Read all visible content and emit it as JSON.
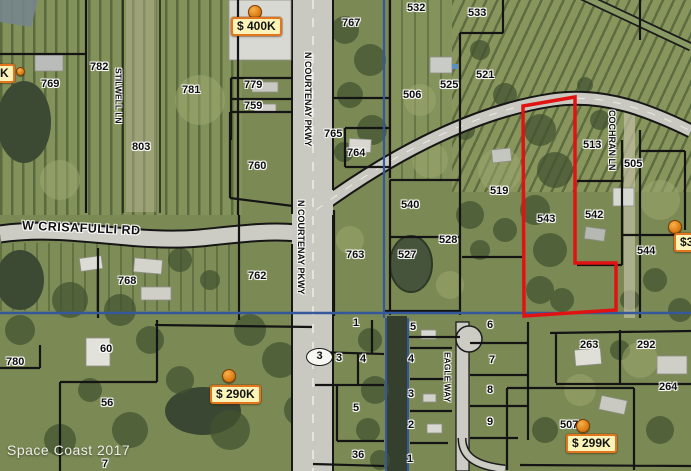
{
  "map": {
    "attribution": "Space Coast 2017",
    "route_shield": "3",
    "colors": {
      "badge_bg": "#fbf3b8",
      "badge_border": "#e2761e",
      "pin_orange": "#e0821a",
      "selected_parcel_outline": "#e01212",
      "utility_line_blue": "#35589c",
      "parcel_line_black": "#141414"
    },
    "road_labels": [
      {
        "text": "N COURTENAY PKWY",
        "x": 303,
        "y": 52,
        "cls": "vert"
      },
      {
        "text": "N COURTENAY PKWY",
        "x": 296,
        "y": 200,
        "cls": "vert"
      },
      {
        "text": "STILWELL LN",
        "x": 114,
        "y": 68,
        "cls": "vert tight"
      },
      {
        "text": "COCHRAN LN",
        "x": 607,
        "y": 110,
        "cls": "vert"
      },
      {
        "text": "EAGLE WAY",
        "x": 443,
        "y": 352,
        "cls": "vert tight"
      },
      {
        "text": "W CRISAFULLI RD",
        "x": 22,
        "y": 222,
        "cls": "horiz"
      }
    ],
    "parcel_labels": [
      {
        "text": "782",
        "x": 90,
        "y": 62
      },
      {
        "text": "769",
        "x": 41,
        "y": 79
      },
      {
        "text": "781",
        "x": 182,
        "y": 85
      },
      {
        "text": "803",
        "x": 132,
        "y": 142
      },
      {
        "text": "779",
        "x": 244,
        "y": 80
      },
      {
        "text": "759",
        "x": 244,
        "y": 101
      },
      {
        "text": "767",
        "x": 342,
        "y": 18
      },
      {
        "text": "532",
        "x": 407,
        "y": 3
      },
      {
        "text": "533",
        "x": 468,
        "y": 8
      },
      {
        "text": "521",
        "x": 476,
        "y": 70
      },
      {
        "text": "525",
        "x": 440,
        "y": 80
      },
      {
        "text": "506",
        "x": 403,
        "y": 90
      },
      {
        "text": "513",
        "x": 583,
        "y": 140
      },
      {
        "text": "505",
        "x": 624,
        "y": 159
      },
      {
        "text": "760",
        "x": 248,
        "y": 161
      },
      {
        "text": "765",
        "x": 324,
        "y": 129
      },
      {
        "text": "764",
        "x": 347,
        "y": 148
      },
      {
        "text": "763",
        "x": 346,
        "y": 250
      },
      {
        "text": "540",
        "x": 401,
        "y": 200
      },
      {
        "text": "528",
        "x": 439,
        "y": 235
      },
      {
        "text": "527",
        "x": 398,
        "y": 250
      },
      {
        "text": "519",
        "x": 490,
        "y": 186
      },
      {
        "text": "543",
        "x": 537,
        "y": 214
      },
      {
        "text": "542",
        "x": 585,
        "y": 210
      },
      {
        "text": "544",
        "x": 637,
        "y": 246
      },
      {
        "text": "762",
        "x": 248,
        "y": 271
      },
      {
        "text": "768",
        "x": 118,
        "y": 276
      },
      {
        "text": "780",
        "x": 6,
        "y": 357
      },
      {
        "text": "60",
        "x": 100,
        "y": 344
      },
      {
        "text": "56",
        "x": 101,
        "y": 398
      },
      {
        "text": "7",
        "x": 102,
        "y": 459
      },
      {
        "text": "1",
        "x": 353,
        "y": 318
      },
      {
        "text": "3",
        "x": 336,
        "y": 353
      },
      {
        "text": "4",
        "x": 360,
        "y": 354
      },
      {
        "text": "5",
        "x": 353,
        "y": 403
      },
      {
        "text": "36",
        "x": 352,
        "y": 450
      },
      {
        "text": "5",
        "x": 410,
        "y": 322
      },
      {
        "text": "4",
        "x": 408,
        "y": 354
      },
      {
        "text": "3",
        "x": 408,
        "y": 389
      },
      {
        "text": "2",
        "x": 408,
        "y": 420
      },
      {
        "text": "1",
        "x": 407,
        "y": 454
      },
      {
        "text": "6",
        "x": 487,
        "y": 320
      },
      {
        "text": "7",
        "x": 489,
        "y": 355
      },
      {
        "text": "8",
        "x": 487,
        "y": 385
      },
      {
        "text": "9",
        "x": 487,
        "y": 417
      },
      {
        "text": "263",
        "x": 580,
        "y": 340
      },
      {
        "text": "292",
        "x": 637,
        "y": 340
      },
      {
        "text": "264",
        "x": 659,
        "y": 382
      },
      {
        "text": "507",
        "x": 560,
        "y": 420
      }
    ],
    "price_badges": [
      {
        "text": "$ 400K",
        "x": 231,
        "y": 17
      },
      {
        "text": "$ 290K",
        "x": 210,
        "y": 385
      },
      {
        "text": "$ 299K",
        "x": 566,
        "y": 434
      },
      {
        "text": "$3",
        "x": 674,
        "y": 233
      },
      {
        "text": "K",
        "x": -6,
        "y": 64
      }
    ],
    "pins": [
      {
        "x": 248,
        "y": 5
      },
      {
        "x": 222,
        "y": 369
      },
      {
        "x": 576,
        "y": 419
      },
      {
        "x": 668,
        "y": 220
      },
      {
        "x": 16,
        "y": 67,
        "cls": "sm"
      }
    ]
  }
}
